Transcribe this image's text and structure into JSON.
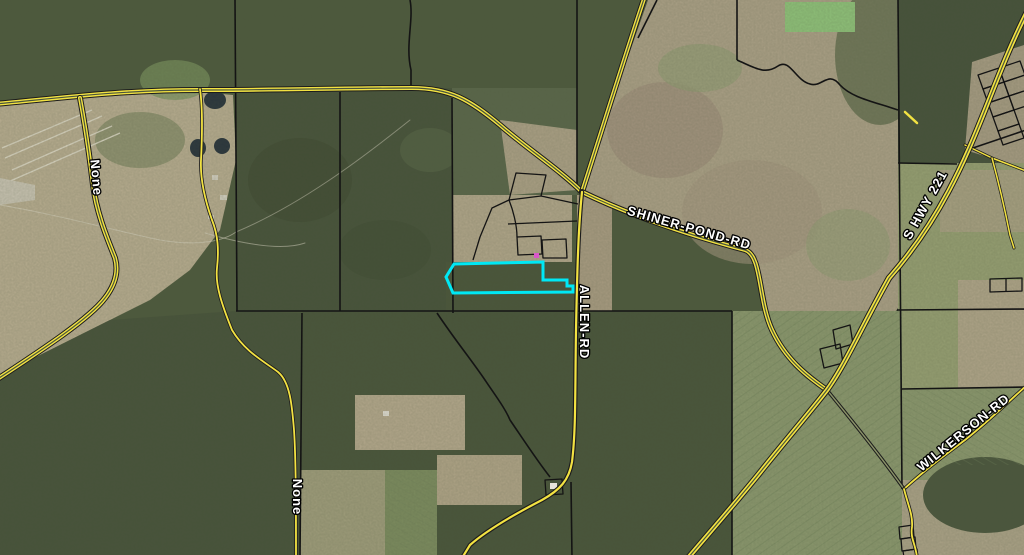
{
  "map": {
    "labels": {
      "shiner_pond": "SHINER-POND-RD",
      "allen": "ALLEN-RD",
      "hwy221": "S HWY 221",
      "wilkerson": "WILKERSON-RD",
      "none_west": "None",
      "none_south": "None"
    },
    "colors": {
      "road_fill": "#f2e242",
      "road_casing": "#1c1c1c",
      "parcel_line": "#141414",
      "highlight": "#00e8f5",
      "selection_point": "#d957c9",
      "label_fill": "#ffffff",
      "label_outline": "#000000"
    }
  }
}
